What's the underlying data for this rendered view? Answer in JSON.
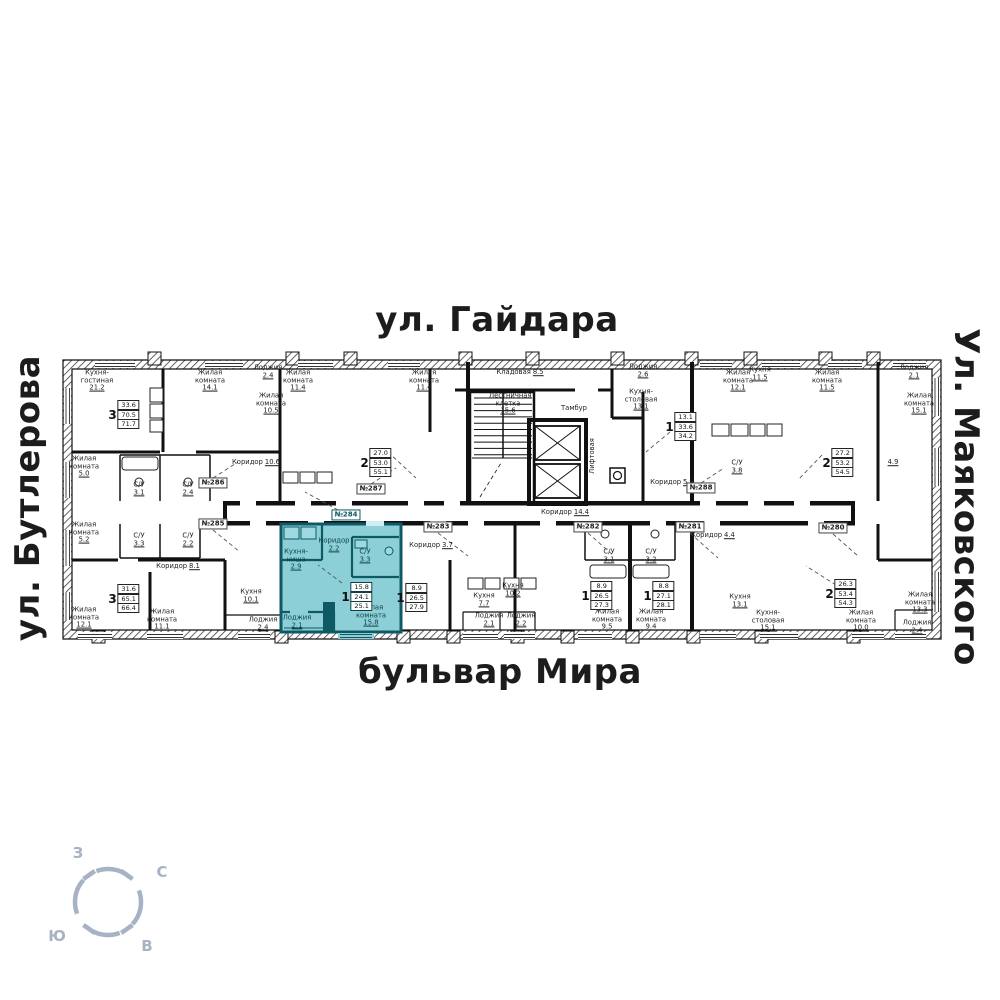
{
  "streets": {
    "top": "ул. Гайдара",
    "bottom": "бульвар Мира",
    "left": "ул. Бутлерова",
    "right": "Ул. Маяковского"
  },
  "compass": {
    "west": "З",
    "north": "С",
    "south": "Ю",
    "east": "В",
    "color": "#a7b3c4"
  },
  "colors": {
    "highlight_fill": "#8ccfd7",
    "highlight_wall": "#0e5a64",
    "wall": "#111111"
  },
  "highlighted_apartment": {
    "number": "№284",
    "rooms": "1",
    "living_area": "15.8",
    "area": "24.1",
    "total_area": "25.1"
  },
  "apartment_tags": [
    {
      "label": "№286",
      "x": 213,
      "y": 483,
      "hl": false
    },
    {
      "label": "№287",
      "x": 371,
      "y": 489,
      "hl": false
    },
    {
      "label": "№288",
      "x": 701,
      "y": 488,
      "hl": false
    },
    {
      "label": "№285",
      "x": 213,
      "y": 524,
      "hl": false
    },
    {
      "label": "№284",
      "x": 346,
      "y": 515,
      "hl": true
    },
    {
      "label": "№283",
      "x": 438,
      "y": 527,
      "hl": false
    },
    {
      "label": "№282",
      "x": 588,
      "y": 527,
      "hl": false
    },
    {
      "label": "№281",
      "x": 690,
      "y": 527,
      "hl": false
    },
    {
      "label": "№280",
      "x": 833,
      "y": 528,
      "hl": false
    }
  ],
  "badges": [
    {
      "digit": "3",
      "values": [
        "33.6",
        "70.5",
        "71.7"
      ],
      "x": 124,
      "y": 415,
      "hl": false
    },
    {
      "digit": "2",
      "values": [
        "27.0",
        "53.0",
        "55.1"
      ],
      "x": 376,
      "y": 463,
      "hl": false
    },
    {
      "digit": "1",
      "values": [
        "13.1",
        "33.6",
        "34.2"
      ],
      "x": 681,
      "y": 427,
      "hl": false
    },
    {
      "digit": "2",
      "values": [
        "27.2",
        "53.2",
        "54.5"
      ],
      "x": 838,
      "y": 463,
      "hl": false
    },
    {
      "digit": "3",
      "values": [
        "31.6",
        "65.1",
        "66.4"
      ],
      "x": 124,
      "y": 599,
      "hl": false
    },
    {
      "digit": "1",
      "values": [
        "15.8",
        "24.1",
        "25.1"
      ],
      "x": 357,
      "y": 597,
      "hl": true
    },
    {
      "digit": "1",
      "values": [
        "8.9",
        "26.5",
        "27.9"
      ],
      "x": 412,
      "y": 598,
      "hl": false
    },
    {
      "digit": "1",
      "values": [
        "8.9",
        "26.5",
        "27.3"
      ],
      "x": 597,
      "y": 596,
      "hl": false
    },
    {
      "digit": "1",
      "values": [
        "8.8",
        "27.1",
        "28.1"
      ],
      "x": 659,
      "y": 596,
      "hl": false
    },
    {
      "digit": "2",
      "values": [
        "26.3",
        "53.4",
        "54.3"
      ],
      "x": 841,
      "y": 594,
      "hl": false
    }
  ],
  "room_labels": [
    {
      "name": "Кухня-гостиная",
      "value": "21.2",
      "x": 97,
      "y": 381
    },
    {
      "name": "Жилая комната",
      "value": "14.1",
      "x": 210,
      "y": 381
    },
    {
      "name": "Лоджия",
      "value": "2.4",
      "x": 268,
      "y": 372
    },
    {
      "name": "Жилая комната",
      "value": "10.5",
      "x": 271,
      "y": 404
    },
    {
      "name": "Жилая комната",
      "value": "5.0",
      "x": 84,
      "y": 467
    },
    {
      "name": "С/У",
      "value": "3.1",
      "x": 139,
      "y": 489
    },
    {
      "name": "С/У",
      "value": "2.4",
      "x": 188,
      "y": 489
    },
    {
      "name": "Коридор",
      "value": "10.6",
      "x": 256,
      "y": 463,
      "inline": true
    },
    {
      "name": "Жилая комната",
      "value": "11.4",
      "x": 298,
      "y": 381
    },
    {
      "name": "Жилая комната",
      "value": "11.4",
      "x": 424,
      "y": 381
    },
    {
      "name": "Кладовая",
      "value": "8.5",
      "x": 520,
      "y": 373,
      "inline": true
    },
    {
      "name": "Лестничная клетка",
      "value": "15.6",
      "x": 508,
      "y": 404
    },
    {
      "name": "Тамбур",
      "value": "",
      "x": 574,
      "y": 409
    },
    {
      "name": "Лифтовая",
      "value": "",
      "x": 593,
      "y": 456,
      "rot": -90
    },
    {
      "name": "Коридор",
      "value": "14.4",
      "x": 565,
      "y": 513,
      "inline": true
    },
    {
      "name": "Лоджия",
      "value": "2.6",
      "x": 643,
      "y": 371
    },
    {
      "name": "Кухня-столовая",
      "value": "13.1",
      "x": 641,
      "y": 400
    },
    {
      "name": "Коридор",
      "value": "5.9",
      "x": 672,
      "y": 483,
      "inline": true
    },
    {
      "name": "Жилая комната",
      "value": "12.1",
      "x": 738,
      "y": 381
    },
    {
      "name": "Кухня",
      "value": "11.5",
      "x": 760,
      "y": 374
    },
    {
      "name": "Жилая комната",
      "value": "11.5",
      "x": 827,
      "y": 381
    },
    {
      "name": "С/У",
      "value": "3.8",
      "x": 737,
      "y": 467
    },
    {
      "name": "",
      "value": "4.9",
      "x": 893,
      "y": 463
    },
    {
      "name": "Лоджия",
      "value": "2.1",
      "x": 914,
      "y": 372
    },
    {
      "name": "Жилая комната",
      "value": "15.1",
      "x": 919,
      "y": 404
    },
    {
      "name": "Жилая комната",
      "value": "5.2",
      "x": 84,
      "y": 533
    },
    {
      "name": "С/У",
      "value": "3.3",
      "x": 139,
      "y": 540
    },
    {
      "name": "С/У",
      "value": "2.2",
      "x": 188,
      "y": 540
    },
    {
      "name": "Коридор",
      "value": "8.1",
      "x": 178,
      "y": 567,
      "inline": true
    },
    {
      "name": "Жилая комната",
      "value": "12.1",
      "x": 84,
      "y": 618
    },
    {
      "name": "Жилая комната",
      "value": "11.1",
      "x": 162,
      "y": 620
    },
    {
      "name": "Кухня",
      "value": "10.1",
      "x": 251,
      "y": 596
    },
    {
      "name": "Лоджия",
      "value": "2.4",
      "x": 263,
      "y": 624
    },
    {
      "name": "Кухня-ниша",
      "value": "2.9",
      "x": 296,
      "y": 560,
      "teal": true
    },
    {
      "name": "Коридор",
      "value": "2.2",
      "x": 334,
      "y": 545,
      "teal": true
    },
    {
      "name": "С/У",
      "value": "3.3",
      "x": 365,
      "y": 556,
      "teal": true
    },
    {
      "name": "Жилая комната",
      "value": "15.8",
      "x": 371,
      "y": 616,
      "teal": true
    },
    {
      "name": "Лоджия",
      "value": "2.1",
      "x": 297,
      "y": 622,
      "teal": true
    },
    {
      "name": "Коридор",
      "value": "3.7",
      "x": 431,
      "y": 546,
      "inline": true
    },
    {
      "name": "Кухня",
      "value": "7.7",
      "x": 484,
      "y": 600
    },
    {
      "name": "Кухня",
      "value": "10.2",
      "x": 513,
      "y": 590
    },
    {
      "name": "Лоджия",
      "value": "2.1",
      "x": 489,
      "y": 620
    },
    {
      "name": "Лоджия",
      "value": "2.2",
      "x": 521,
      "y": 620
    },
    {
      "name": "С/У",
      "value": "3.1",
      "x": 609,
      "y": 556
    },
    {
      "name": "С/У",
      "value": "3.2",
      "x": 651,
      "y": 556
    },
    {
      "name": "Жилая комната",
      "value": "9.5",
      "x": 607,
      "y": 620
    },
    {
      "name": "Жилая комната",
      "value": "9.4",
      "x": 651,
      "y": 620
    },
    {
      "name": "Коридор",
      "value": "4.4",
      "x": 713,
      "y": 536,
      "inline": true
    },
    {
      "name": "Кухня",
      "value": "13.1",
      "x": 740,
      "y": 601
    },
    {
      "name": "Кухня-столовая",
      "value": "15.1",
      "x": 768,
      "y": 621
    },
    {
      "name": "Жилая комната",
      "value": "10.0",
      "x": 861,
      "y": 621
    },
    {
      "name": "Жилая комната",
      "value": "13.3",
      "x": 920,
      "y": 603
    },
    {
      "name": "Лоджия",
      "value": "2.4",
      "x": 917,
      "y": 627
    }
  ]
}
